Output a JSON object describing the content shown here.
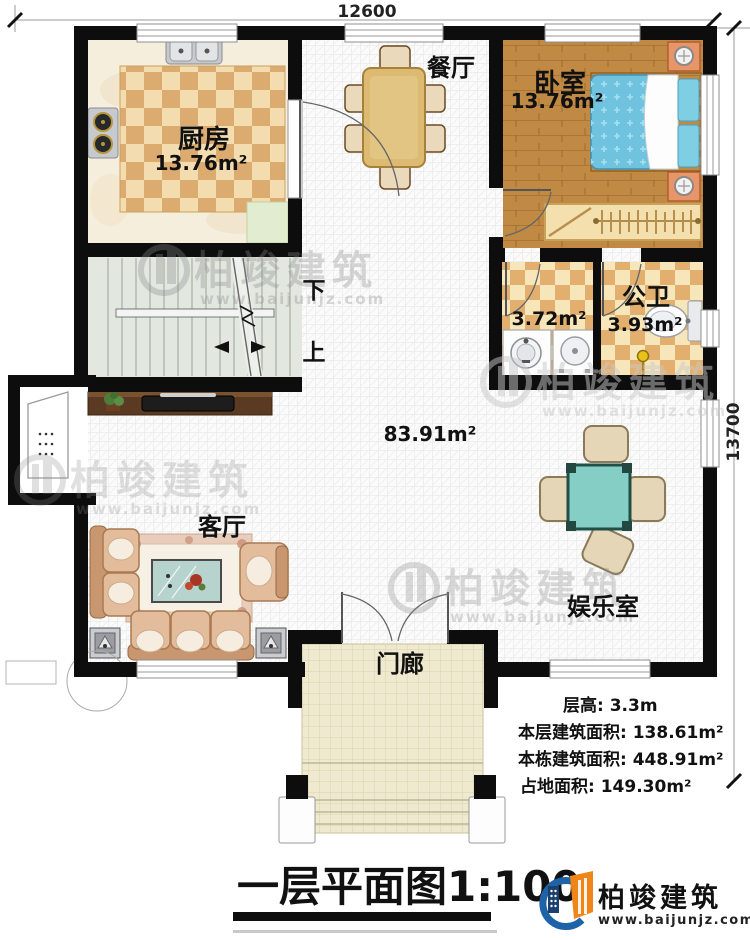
{
  "dimensions": {
    "width_mm": "12600",
    "depth_mm": "13700"
  },
  "rooms": {
    "kitchen": {
      "name": "厨房",
      "area": "13.76m²"
    },
    "dining": {
      "name": "餐厅"
    },
    "bedroom": {
      "name": "卧室",
      "area": "13.76m²"
    },
    "bath": {
      "area": "3.72m²"
    },
    "public_bath": {
      "name": "公卫",
      "area": "3.93m²"
    },
    "living": {
      "name": "客厅"
    },
    "game_room": {
      "name": "娱乐室"
    },
    "porch": {
      "name": "门廊"
    },
    "hall": {
      "area": "83.91m²"
    }
  },
  "stairs": {
    "down_label": "下",
    "up_label": "上"
  },
  "info": {
    "line1": "层高: 3.3m",
    "line2": "本层建筑面积: 138.61m²",
    "line3": "本栋建筑面积: 448.91m²",
    "line4": "占地面积: 149.30m²"
  },
  "title": {
    "text": "一层平面图",
    "scale": "1:100"
  },
  "brand": {
    "name": "柏竣建筑",
    "website": "www.baijunjz.com"
  },
  "watermark": {
    "name": "柏竣建筑",
    "website": "www.baijunjz.com"
  },
  "colors": {
    "wall": "#0d0d0d",
    "bed_blue": "#6fc3de",
    "wood_floor": "#c08a44",
    "checker_dark": "#dcab70",
    "checker_light": "#f3ddb0",
    "stair_floor": "#e2e7df",
    "porch_floor": "#efe9cf",
    "logo_blue": "#1e63a8",
    "logo_orange": "#f08519",
    "mahjong_teal": "#85cec5",
    "sofa_tan": "#e3bd9b"
  }
}
